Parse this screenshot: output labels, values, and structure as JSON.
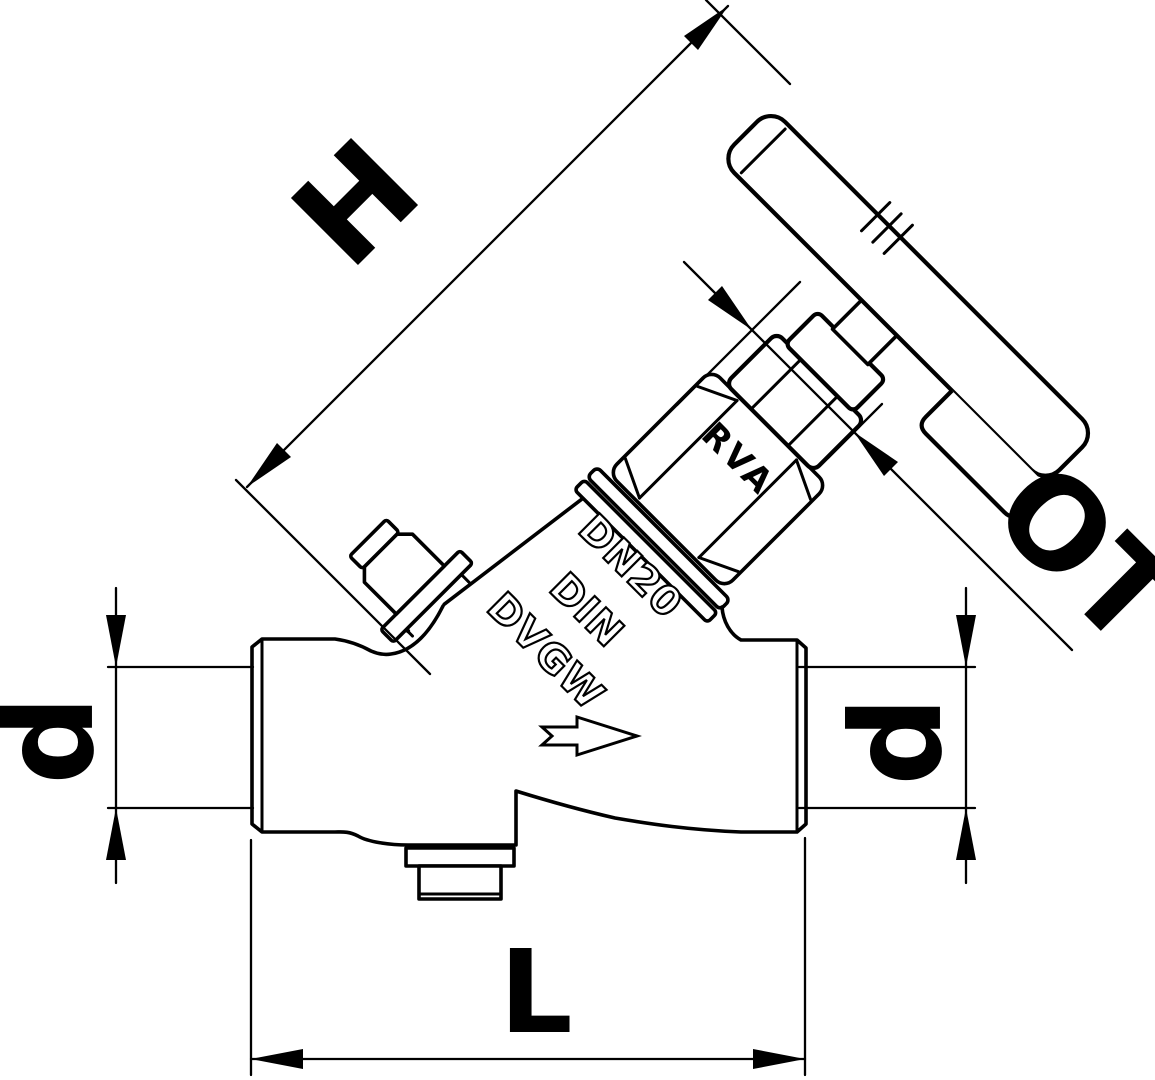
{
  "page": {
    "background_color": "#ffffff",
    "line_color": "#000000"
  },
  "drawing": {
    "type": "technical-dimension-drawing",
    "subject": "angle-seat check valve with tee handle, side view",
    "flow_direction": "right",
    "dimension_labels": {
      "height": "H",
      "upper_part": "OT",
      "diameter_left": "d",
      "diameter_right": "d",
      "length": "L"
    },
    "cast_markings": {
      "model": "RVA",
      "nominal_size": "DN20",
      "standard": "DIN",
      "certification": "DVGW"
    }
  }
}
